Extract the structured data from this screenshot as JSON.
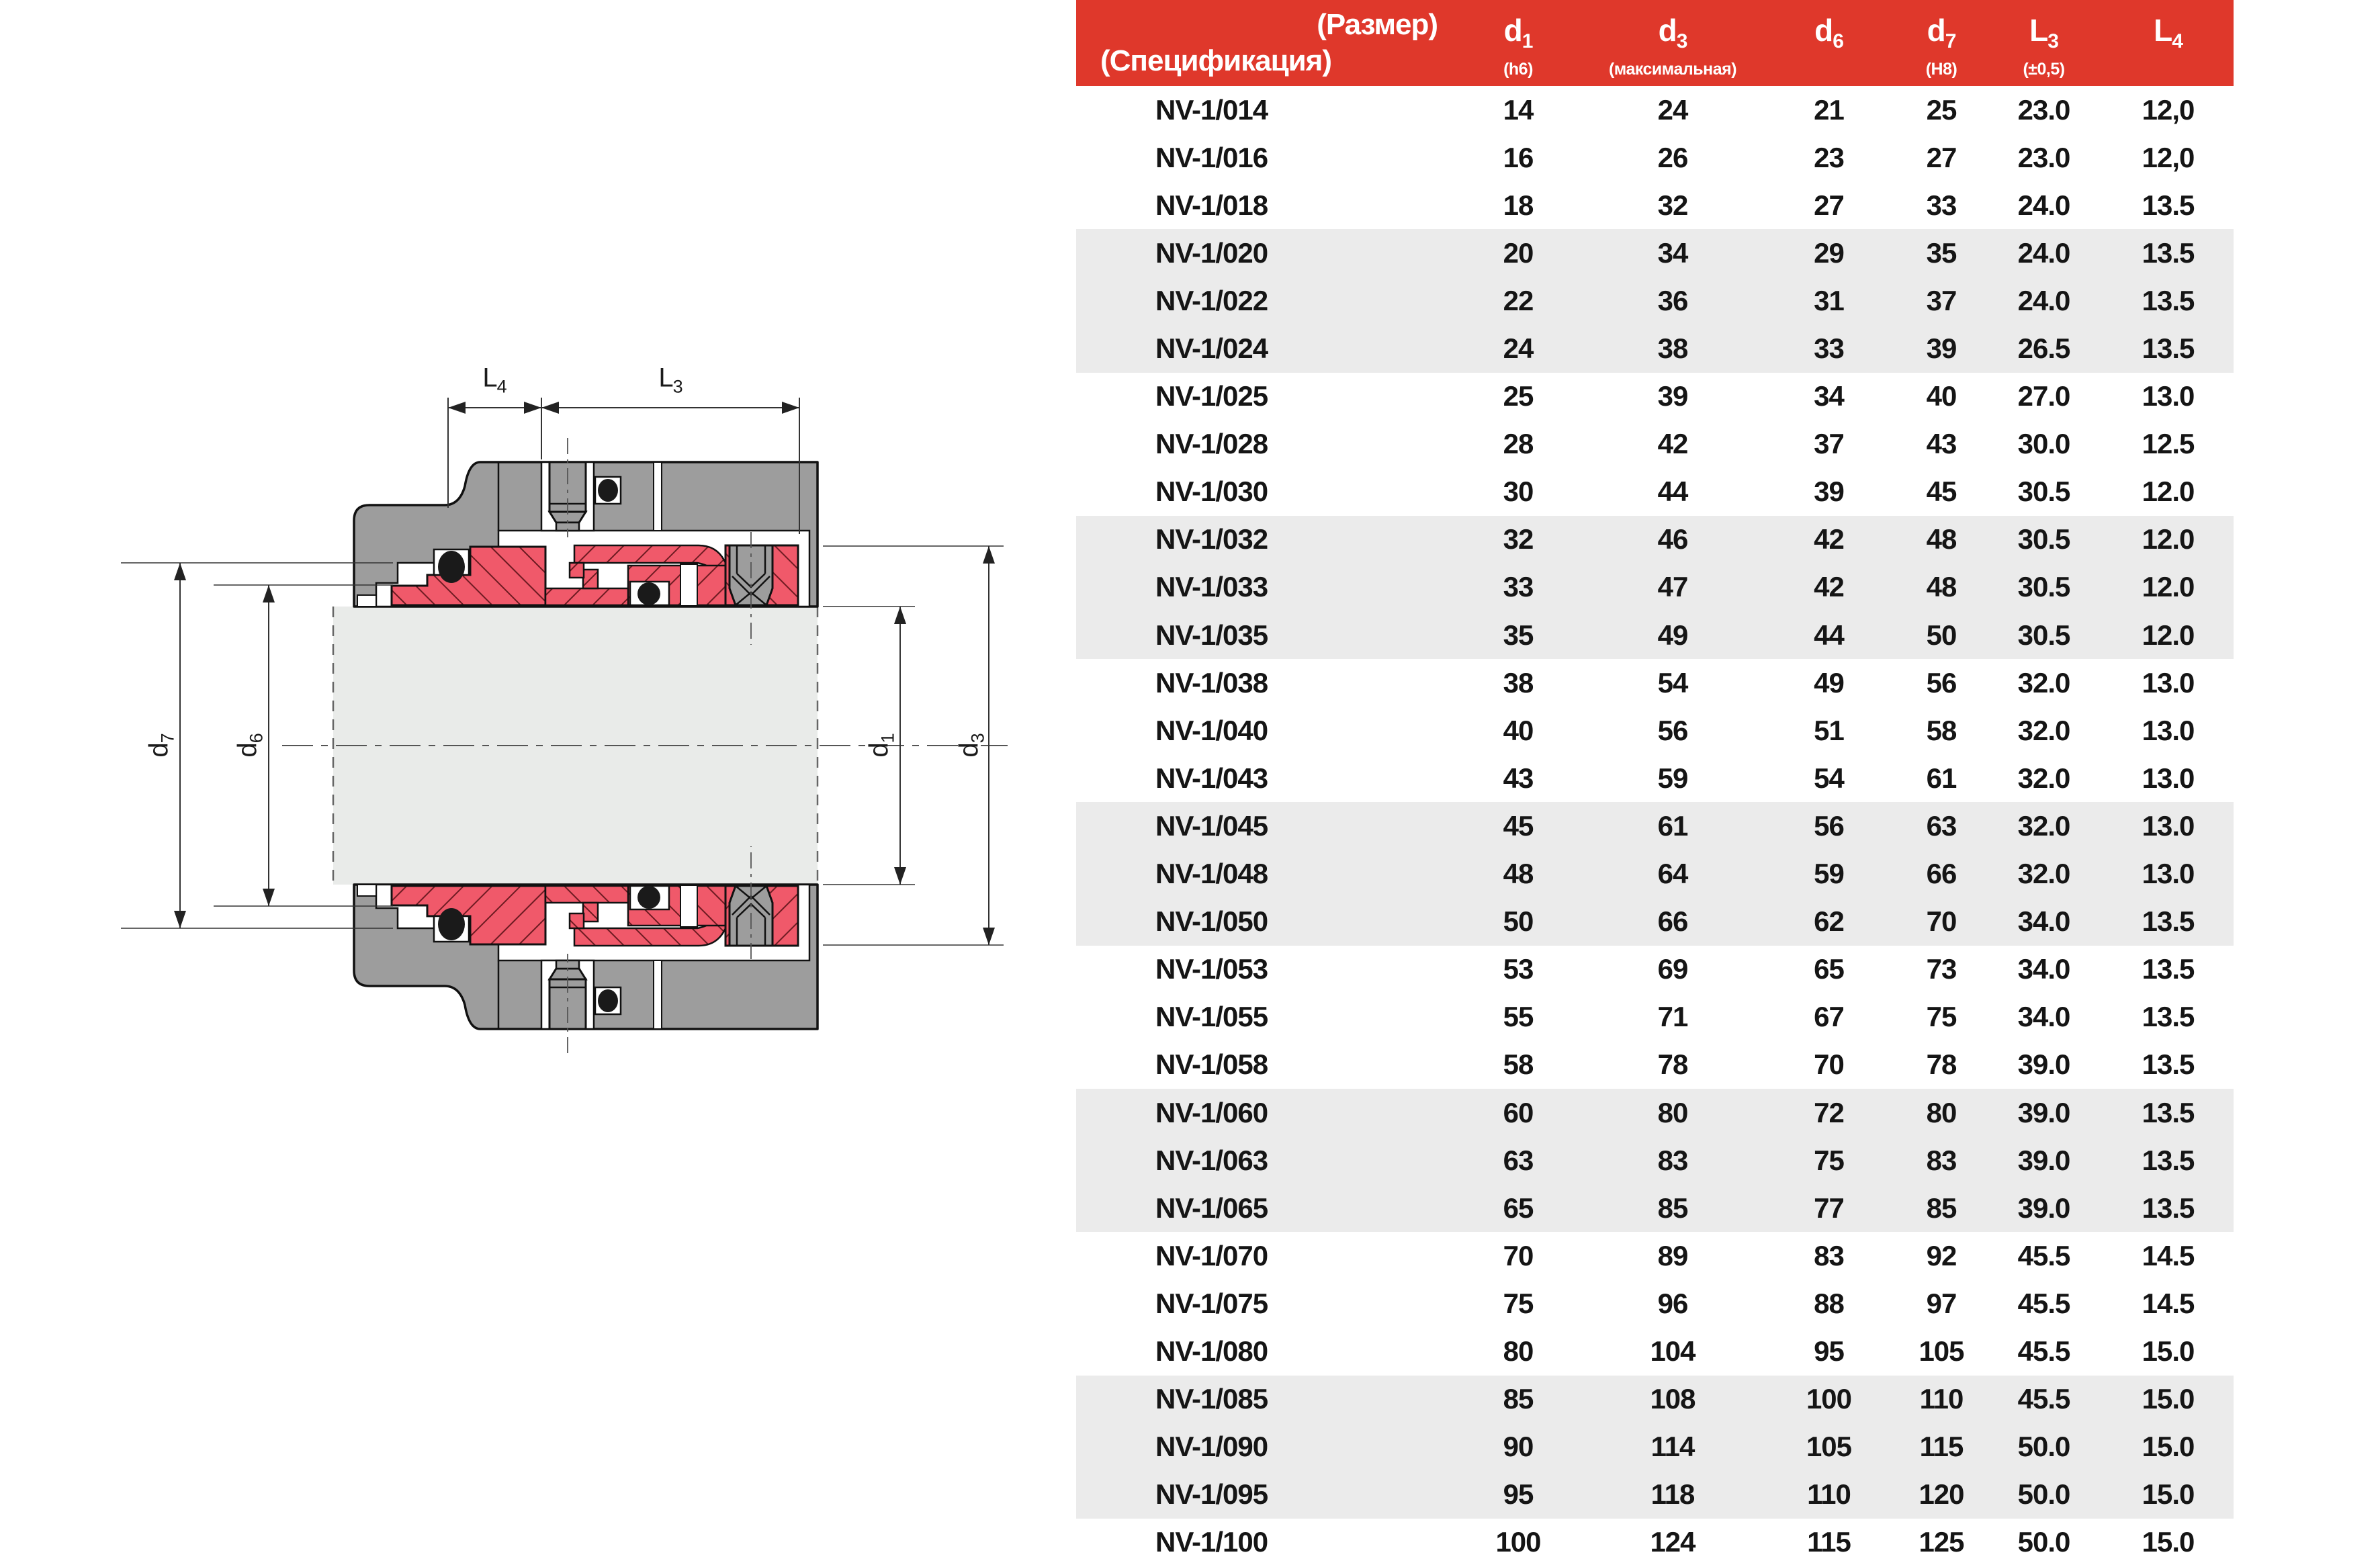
{
  "diagram": {
    "name": "mechanical-seal-cross-section",
    "labels": {
      "l4": {
        "main": "L",
        "sub": "4"
      },
      "l3": {
        "main": "L",
        "sub": "3"
      },
      "d7": {
        "main": "d",
        "sub": "7"
      },
      "d6": {
        "main": "d",
        "sub": "6"
      },
      "d1": {
        "main": "d",
        "sub": "1"
      },
      "d3": {
        "main": "d",
        "sub": "3"
      }
    },
    "colors": {
      "housing_gray": "#9d9d9d",
      "seal_red": "#f0596a",
      "hatch_line": "#6e1b22",
      "shaft_gray": "#e9ebe9",
      "oring_black": "#1a1a1a",
      "outline": "#111111"
    }
  },
  "table": {
    "header": {
      "bg": "#df382b",
      "size_line1": "(Размер)",
      "size_line2": "(Спецификация)",
      "columns": [
        {
          "main": "d",
          "sub": "1",
          "note": "(h6)"
        },
        {
          "main": "d",
          "sub": "3",
          "note": "(максимальная)"
        },
        {
          "main": "d",
          "sub": "6",
          "note": ""
        },
        {
          "main": "d",
          "sub": "7",
          "note": "(H8)"
        },
        {
          "main": "L",
          "sub": "3",
          "note": "(±0,5)"
        },
        {
          "main": "L",
          "sub": "4",
          "note": ""
        }
      ]
    },
    "stripe_color": "#ebebeb",
    "rows": [
      {
        "size": "NV-1/014",
        "d1": "14",
        "d3": "24",
        "d6": "21",
        "d7": "25",
        "l3": "23.0",
        "l4": "12,0",
        "shaded": false
      },
      {
        "size": "NV-1/016",
        "d1": "16",
        "d3": "26",
        "d6": "23",
        "d7": "27",
        "l3": "23.0",
        "l4": "12,0",
        "shaded": false
      },
      {
        "size": "NV-1/018",
        "d1": "18",
        "d3": "32",
        "d6": "27",
        "d7": "33",
        "l3": "24.0",
        "l4": "13.5",
        "shaded": false
      },
      {
        "size": "NV-1/020",
        "d1": "20",
        "d3": "34",
        "d6": "29",
        "d7": "35",
        "l3": "24.0",
        "l4": "13.5",
        "shaded": true
      },
      {
        "size": "NV-1/022",
        "d1": "22",
        "d3": "36",
        "d6": "31",
        "d7": "37",
        "l3": "24.0",
        "l4": "13.5",
        "shaded": true
      },
      {
        "size": "NV-1/024",
        "d1": "24",
        "d3": "38",
        "d6": "33",
        "d7": "39",
        "l3": "26.5",
        "l4": "13.5",
        "shaded": true
      },
      {
        "size": "NV-1/025",
        "d1": "25",
        "d3": "39",
        "d6": "34",
        "d7": "40",
        "l3": "27.0",
        "l4": "13.0",
        "shaded": false
      },
      {
        "size": "NV-1/028",
        "d1": "28",
        "d3": "42",
        "d6": "37",
        "d7": "43",
        "l3": "30.0",
        "l4": "12.5",
        "shaded": false
      },
      {
        "size": "NV-1/030",
        "d1": "30",
        "d3": "44",
        "d6": "39",
        "d7": "45",
        "l3": "30.5",
        "l4": "12.0",
        "shaded": false
      },
      {
        "size": "NV-1/032",
        "d1": "32",
        "d3": "46",
        "d6": "42",
        "d7": "48",
        "l3": "30.5",
        "l4": "12.0",
        "shaded": true
      },
      {
        "size": "NV-1/033",
        "d1": "33",
        "d3": "47",
        "d6": "42",
        "d7": "48",
        "l3": "30.5",
        "l4": "12.0",
        "shaded": true
      },
      {
        "size": "NV-1/035",
        "d1": "35",
        "d3": "49",
        "d6": "44",
        "d7": "50",
        "l3": "30.5",
        "l4": "12.0",
        "shaded": true
      },
      {
        "size": "NV-1/038",
        "d1": "38",
        "d3": "54",
        "d6": "49",
        "d7": "56",
        "l3": "32.0",
        "l4": "13.0",
        "shaded": false
      },
      {
        "size": "NV-1/040",
        "d1": "40",
        "d3": "56",
        "d6": "51",
        "d7": "58",
        "l3": "32.0",
        "l4": "13.0",
        "shaded": false
      },
      {
        "size": "NV-1/043",
        "d1": "43",
        "d3": "59",
        "d6": "54",
        "d7": "61",
        "l3": "32.0",
        "l4": "13.0",
        "shaded": false
      },
      {
        "size": "NV-1/045",
        "d1": "45",
        "d3": "61",
        "d6": "56",
        "d7": "63",
        "l3": "32.0",
        "l4": "13.0",
        "shaded": true
      },
      {
        "size": "NV-1/048",
        "d1": "48",
        "d3": "64",
        "d6": "59",
        "d7": "66",
        "l3": "32.0",
        "l4": "13.0",
        "shaded": true
      },
      {
        "size": "NV-1/050",
        "d1": "50",
        "d3": "66",
        "d6": "62",
        "d7": "70",
        "l3": "34.0",
        "l4": "13.5",
        "shaded": true
      },
      {
        "size": "NV-1/053",
        "d1": "53",
        "d3": "69",
        "d6": "65",
        "d7": "73",
        "l3": "34.0",
        "l4": "13.5",
        "shaded": false
      },
      {
        "size": "NV-1/055",
        "d1": "55",
        "d3": "71",
        "d6": "67",
        "d7": "75",
        "l3": "34.0",
        "l4": "13.5",
        "shaded": false
      },
      {
        "size": "NV-1/058",
        "d1": "58",
        "d3": "78",
        "d6": "70",
        "d7": "78",
        "l3": "39.0",
        "l4": "13.5",
        "shaded": false
      },
      {
        "size": "NV-1/060",
        "d1": "60",
        "d3": "80",
        "d6": "72",
        "d7": "80",
        "l3": "39.0",
        "l4": "13.5",
        "shaded": true
      },
      {
        "size": "NV-1/063",
        "d1": "63",
        "d3": "83",
        "d6": "75",
        "d7": "83",
        "l3": "39.0",
        "l4": "13.5",
        "shaded": true
      },
      {
        "size": "NV-1/065",
        "d1": "65",
        "d3": "85",
        "d6": "77",
        "d7": "85",
        "l3": "39.0",
        "l4": "13.5",
        "shaded": true
      },
      {
        "size": "NV-1/070",
        "d1": "70",
        "d3": "89",
        "d6": "83",
        "d7": "92",
        "l3": "45.5",
        "l4": "14.5",
        "shaded": false
      },
      {
        "size": "NV-1/075",
        "d1": "75",
        "d3": "96",
        "d6": "88",
        "d7": "97",
        "l3": "45.5",
        "l4": "14.5",
        "shaded": false
      },
      {
        "size": "NV-1/080",
        "d1": "80",
        "d3": "104",
        "d6": "95",
        "d7": "105",
        "l3": "45.5",
        "l4": "15.0",
        "shaded": false
      },
      {
        "size": "NV-1/085",
        "d1": "85",
        "d3": "108",
        "d6": "100",
        "d7": "110",
        "l3": "45.5",
        "l4": "15.0",
        "shaded": true
      },
      {
        "size": "NV-1/090",
        "d1": "90",
        "d3": "114",
        "d6": "105",
        "d7": "115",
        "l3": "50.0",
        "l4": "15.0",
        "shaded": true
      },
      {
        "size": "NV-1/095",
        "d1": "95",
        "d3": "118",
        "d6": "110",
        "d7": "120",
        "l3": "50.0",
        "l4": "15.0",
        "shaded": true
      },
      {
        "size": "NV-1/100",
        "d1": "100",
        "d3": "124",
        "d6": "115",
        "d7": "125",
        "l3": "50.0",
        "l4": "15.0",
        "shaded": false
      }
    ]
  }
}
